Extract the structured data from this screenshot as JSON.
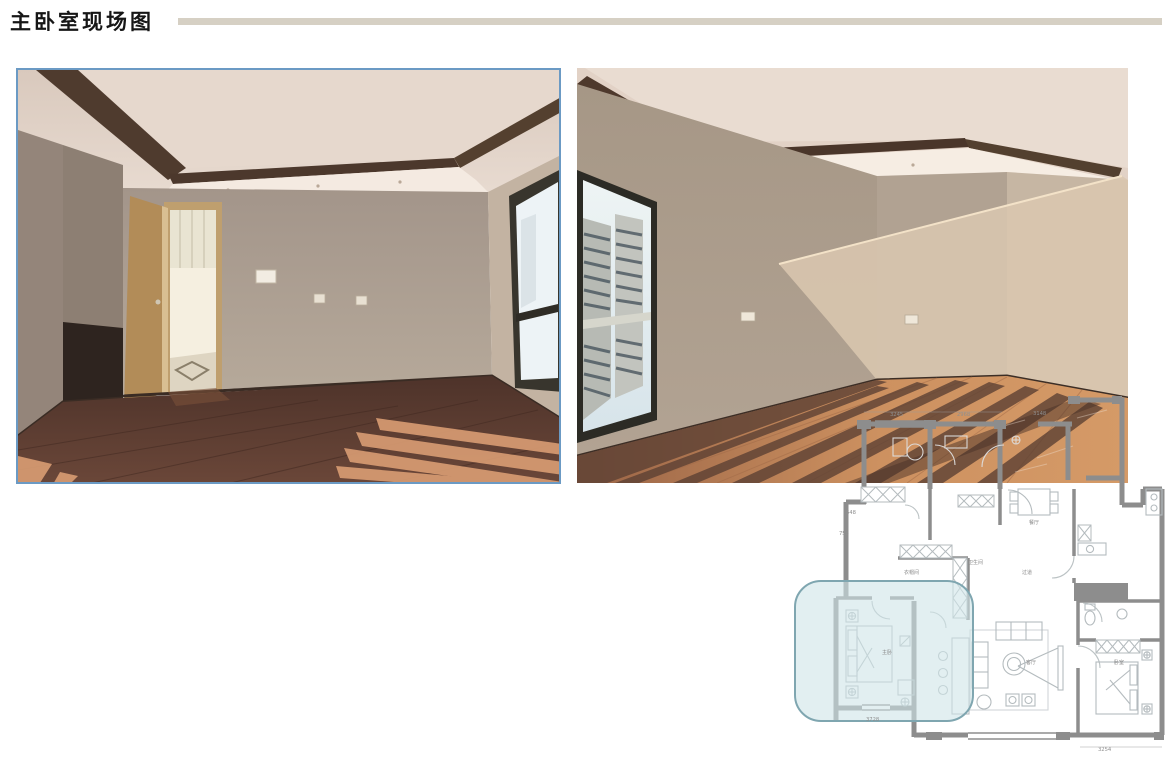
{
  "page": {
    "title": "主卧室现场图"
  },
  "colors": {
    "title_rule": "#d6d0c4",
    "photo_border": "#6b9ac4",
    "plan_wall": "#8d8d8d",
    "plan_furniture": "#b4bbbe",
    "highlight_fill": "#cfe4e8",
    "highlight_border": "#7fa6b0"
  },
  "floor_plan": {
    "dimensions": {
      "top": [
        "3245",
        "2968",
        "3148"
      ],
      "left": [
        "648",
        "756"
      ],
      "bottom": [
        "3728",
        "3254"
      ]
    },
    "rooms": [
      {
        "label": "衣帽间"
      },
      {
        "label": "卫生间"
      },
      {
        "label": "餐厅"
      },
      {
        "label": "过道"
      },
      {
        "label": "主卧"
      },
      {
        "label": "客厅"
      },
      {
        "label": "卧室"
      }
    ]
  }
}
